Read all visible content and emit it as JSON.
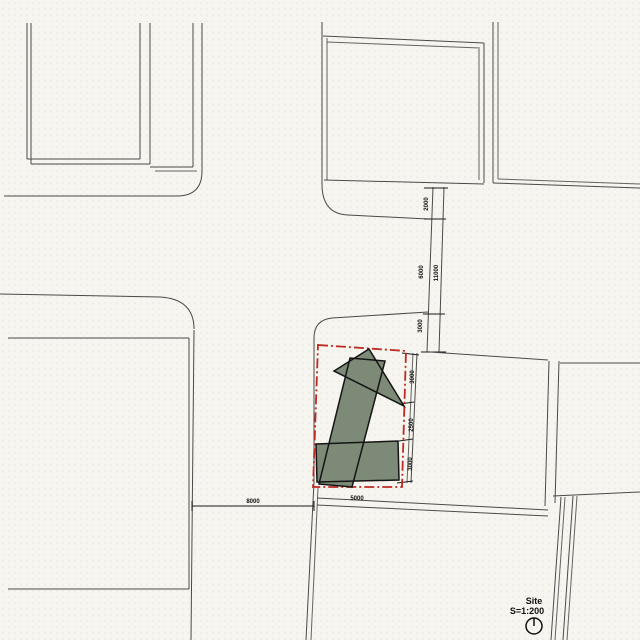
{
  "title_block": {
    "label": "Site",
    "scale": "S=1:200"
  },
  "dimensions": {
    "path_chain": [
      "2000",
      "6000",
      "11000",
      "3000"
    ],
    "east_chain": [
      "3000",
      "2500",
      "3000"
    ],
    "bottom_road": "8000",
    "site_frontage": "5000"
  },
  "icons": {
    "north_arrow": "north-arrow-icon"
  },
  "colors": {
    "background": "#f6f5ef",
    "line": "#4a4a4a",
    "line_dark": "#1c1c1c",
    "site_boundary_red": "#bf2a24",
    "building_green": "#7d8a77",
    "building_outline": "#141414",
    "text": "#111111"
  }
}
